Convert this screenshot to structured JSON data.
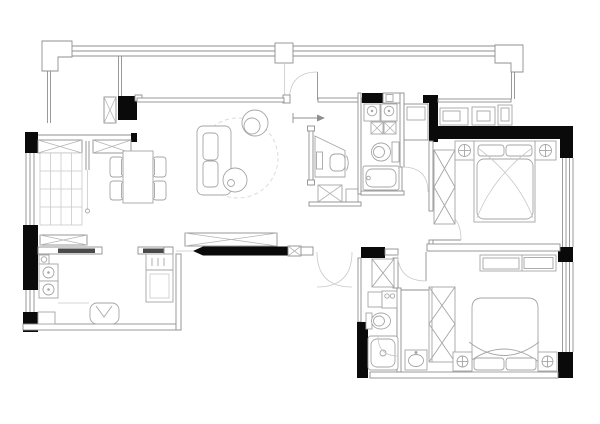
{
  "canvas": {
    "width": 600,
    "height": 424,
    "background": "#ffffff"
  },
  "palette": {
    "wall": "#0a0a0a",
    "line": "#8f8f8f",
    "furniture": "#a6a6a6",
    "hatch": "#b5b5b5",
    "light": "#c9c9c9",
    "slab": "#4a4a4a",
    "rug": "#dcdcdc",
    "background": "#ffffff"
  },
  "floorplan": {
    "type": "apartment-floor-plan",
    "visible_text": [],
    "rooms": [
      {
        "name": "balcony",
        "features": [
          "window-band",
          "structural-columns",
          "ac-unit",
          "balcony-door"
        ]
      },
      {
        "name": "living-room",
        "furniture": [
          "sofa",
          "coffee-table",
          "swivel-armchair",
          "round-rug",
          "tv-cabinet"
        ]
      },
      {
        "name": "dining-room",
        "furniture": [
          "dining-table",
          "four-chairs",
          "grid-storage-cabinet",
          "sideboard",
          "sliding-door"
        ]
      },
      {
        "name": "kitchen",
        "furniture": [
          "counter-with-sink",
          "two-burner-stove",
          "refrigerator",
          "stool",
          "base-cabinet"
        ]
      },
      {
        "name": "study-nook",
        "furniture": [
          "desk",
          "monitor",
          "desk-chair",
          "hatched-cabinet",
          "side-box"
        ]
      },
      {
        "name": "bathroom-1",
        "fixtures": [
          "washer",
          "dryer",
          "storage-boxes",
          "toilet",
          "bathtub",
          "door"
        ]
      },
      {
        "name": "hallway",
        "features": [
          "built-in-cabinet",
          "corridor"
        ]
      },
      {
        "name": "bedroom-1",
        "furniture": [
          "double-bed",
          "pillows",
          "two-nightstand-lamps",
          "wardrobe",
          "dresser-row",
          "door"
        ]
      },
      {
        "name": "entry",
        "features": [
          "double-entry-door",
          "shoe-cabinet",
          "threshold"
        ]
      },
      {
        "name": "bathroom-2",
        "fixtures": [
          "linen-closet",
          "sink-counter",
          "toilet",
          "shower-stall",
          "door"
        ]
      },
      {
        "name": "bedroom-2",
        "furniture": [
          "double-bed",
          "pillows",
          "two-nightstand-lamps",
          "wardrobe",
          "headboard-shelf",
          "vanity-basin"
        ]
      }
    ]
  }
}
